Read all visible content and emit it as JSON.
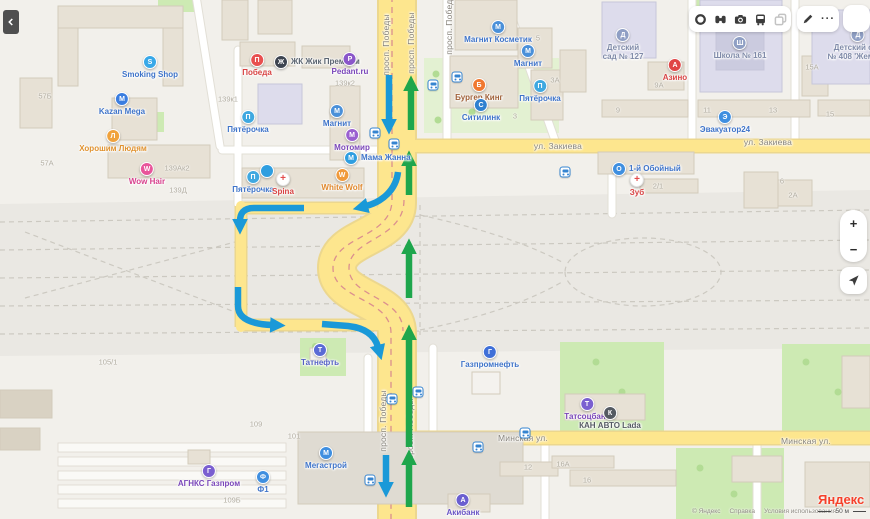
{
  "toolbar": {
    "more_label": "···"
  },
  "controls": {
    "zoom_in": "+",
    "zoom_out": "−"
  },
  "attribution": {
    "logo": "Яндекс",
    "copyright": "© Яндекс",
    "help": "Справка",
    "terms": "Условия использования",
    "scale": "50 м"
  },
  "map": {
    "streets": [
      {
        "text": "просп. Победы",
        "x": 386,
        "y": 45,
        "vertical": true
      },
      {
        "text": "просп. Победы",
        "x": 411,
        "y": 43,
        "vertical": true
      },
      {
        "text": "просп. Победы",
        "x": 449,
        "y": 24,
        "vertical": true
      },
      {
        "text": "просп. Победы",
        "x": 383,
        "y": 421,
        "vertical": true
      },
      {
        "text": "просп. Победы",
        "x": 410,
        "y": 429,
        "vertical": true
      },
      {
        "text": "ул. Закиева",
        "x": 558,
        "y": 146
      },
      {
        "text": "ул. Закиева",
        "x": 768,
        "y": 142
      },
      {
        "text": "Минская ул.",
        "x": 523,
        "y": 438
      },
      {
        "text": "Минская ул.",
        "x": 806,
        "y": 441
      }
    ],
    "pois": [
      {
        "label": "Smoking Shop",
        "x": 150,
        "y": 63,
        "color": "#38a8e8",
        "glyph": "S"
      },
      {
        "label": "Kazan Mega",
        "x": 122,
        "y": 100,
        "color": "#3a7de0",
        "glyph": "M"
      },
      {
        "label": "Хорошим Людям",
        "x": 113,
        "y": 137,
        "color": "#f0a23c",
        "glyph": "Л",
        "labelColor": "#e0922f"
      },
      {
        "label": "Wow Hair",
        "x": 147,
        "y": 170,
        "color": "#e8559a",
        "glyph": "W",
        "labelColor": "#d8418d"
      },
      {
        "label": "Победа",
        "x": 257,
        "y": 61,
        "color": "#e84f4f",
        "glyph": "П",
        "labelColor": "#d84343"
      },
      {
        "label": "ЖК Жик Премиум",
        "x": 282,
        "y": 62,
        "color": "#3d4450",
        "glyph": "Ж",
        "side": "right",
        "labelColor": "#5a6470"
      },
      {
        "label": "Pedant.ru",
        "x": 350,
        "y": 60,
        "color": "#8a56c9",
        "glyph": "P",
        "labelColor": "#7a46b9"
      },
      {
        "label": "Пятёрочка",
        "x": 248,
        "y": 118,
        "color": "#3fa8e0",
        "glyph": "П"
      },
      {
        "label": "Магнит",
        "x": 337,
        "y": 112,
        "color": "#4a90d9",
        "glyph": "М"
      },
      {
        "label": "Мотомир",
        "x": 352,
        "y": 136,
        "color": "#9a5fd0",
        "glyph": "М",
        "labelColor": "#7a46b9"
      },
      {
        "label": "Мама Жанна",
        "x": 352,
        "y": 158,
        "color": "#2f9ee0",
        "glyph": "М",
        "side": "right"
      },
      {
        "label": "Пятёрочка",
        "x": 253,
        "y": 178,
        "color": "#3fa8e0",
        "glyph": "П"
      },
      {
        "label": "Spina",
        "x": 283,
        "y": 180,
        "color": "#ffffff",
        "glyph": "+",
        "style": "cross",
        "labelColor": "#d84343"
      },
      {
        "label": "White Wolf",
        "x": 342,
        "y": 176,
        "color": "#f09a3c",
        "glyph": "W",
        "labelColor": "#e0892f"
      },
      {
        "label": "",
        "x": 267,
        "y": 172,
        "color": "#2f9ee0",
        "glyph": ""
      },
      {
        "label": "Магнит Косметик",
        "x": 498,
        "y": 28,
        "color": "#4a90d9",
        "glyph": "М"
      },
      {
        "label": "Магнит",
        "x": 528,
        "y": 52,
        "color": "#4a90d9",
        "glyph": "М"
      },
      {
        "label": "Бургер Кинг",
        "x": 479,
        "y": 86,
        "color": "#f07830",
        "glyph": "Б",
        "labelColor": "#a06038"
      },
      {
        "label": "Ситилинк",
        "x": 481,
        "y": 106,
        "color": "#2f80d0",
        "glyph": "С"
      },
      {
        "label": "Пятёрочка",
        "x": 540,
        "y": 87,
        "color": "#3fa8e0",
        "glyph": "П"
      },
      {
        "label": "Детский\nсад № 127",
        "x": 623,
        "y": 36,
        "color": "#8f9fc4",
        "glyph": "Д",
        "labelColor": "#7f8aa8"
      },
      {
        "label": "Школа № 161",
        "x": 740,
        "y": 44,
        "color": "#8f9fc4",
        "glyph": "Ш",
        "labelColor": "#7f8aa8"
      },
      {
        "label": "Азино",
        "x": 675,
        "y": 66,
        "color": "#e04545",
        "glyph": "А",
        "labelColor": "#d84343"
      },
      {
        "label": "Детский сад\n№ 408 'Жемчуж",
        "x": 858,
        "y": 36,
        "color": "#8f9fc4",
        "glyph": "Д",
        "labelColor": "#7f8aa8"
      },
      {
        "label": "Эвакуатор24",
        "x": 725,
        "y": 118,
        "color": "#3f8fe0",
        "glyph": "Э"
      },
      {
        "label": "1-й Обойный",
        "x": 620,
        "y": 169,
        "color": "#3f8fe0",
        "glyph": "О",
        "side": "right"
      },
      {
        "label": "Зуб",
        "x": 637,
        "y": 181,
        "color": "#ffffff",
        "glyph": "+",
        "style": "cross",
        "labelColor": "#d84343"
      },
      {
        "label": "Татнефть",
        "x": 320,
        "y": 351,
        "color": "#5b6bd5",
        "glyph": "Т",
        "labelColor": "#5560c5"
      },
      {
        "label": "Газпромнефть",
        "x": 490,
        "y": 353,
        "color": "#3f6fd8",
        "glyph": "Г"
      },
      {
        "label": "Татсоцбанк",
        "x": 587,
        "y": 405,
        "color": "#7a5fd0",
        "glyph": "Т",
        "labelColor": "#7a46b9"
      },
      {
        "label": "КАН АВТО Lada",
        "x": 610,
        "y": 414,
        "color": "#545a62",
        "glyph": "К",
        "labelColor": "#555b63"
      },
      {
        "label": "Мегастрой",
        "x": 326,
        "y": 454,
        "color": "#3f8fe0",
        "glyph": "М"
      },
      {
        "label": "АГНКС Газпром",
        "x": 209,
        "y": 472,
        "color": "#7a5fd0",
        "glyph": "Г",
        "labelColor": "#7a46b9"
      },
      {
        "label": "Ф1",
        "x": 263,
        "y": 478,
        "color": "#3f8fe0",
        "glyph": "Ф"
      },
      {
        "label": "Акибанк",
        "x": 463,
        "y": 501,
        "color": "#6a5fd0",
        "glyph": "А",
        "labelColor": "#6a55c5"
      }
    ],
    "bus_stops": [
      {
        "x": 375,
        "y": 133
      },
      {
        "x": 394,
        "y": 144
      },
      {
        "x": 433,
        "y": 85
      },
      {
        "x": 457,
        "y": 77
      },
      {
        "x": 392,
        "y": 399
      },
      {
        "x": 418,
        "y": 392
      },
      {
        "x": 370,
        "y": 480
      },
      {
        "x": 478,
        "y": 447
      },
      {
        "x": 525,
        "y": 433
      },
      {
        "x": 565,
        "y": 172
      }
    ],
    "building_numbers": [
      {
        "text": "57Б",
        "x": 45,
        "y": 96
      },
      {
        "text": "57А",
        "x": 47,
        "y": 163
      },
      {
        "text": "139Ак2",
        "x": 177,
        "y": 168
      },
      {
        "text": "139Д",
        "x": 178,
        "y": 190
      },
      {
        "text": "139к1",
        "x": 228,
        "y": 99
      },
      {
        "text": "139к2",
        "x": 345,
        "y": 83
      },
      {
        "text": "105/1",
        "x": 108,
        "y": 362
      },
      {
        "text": "109",
        "x": 256,
        "y": 424
      },
      {
        "text": "109Б",
        "x": 232,
        "y": 500
      },
      {
        "text": "101",
        "x": 294,
        "y": 436
      },
      {
        "text": "9А",
        "x": 659,
        "y": 85
      },
      {
        "text": "9",
        "x": 618,
        "y": 110
      },
      {
        "text": "11",
        "x": 707,
        "y": 110
      },
      {
        "text": "13",
        "x": 773,
        "y": 110
      },
      {
        "text": "15А",
        "x": 812,
        "y": 67
      },
      {
        "text": "15",
        "x": 830,
        "y": 114
      },
      {
        "text": "3А",
        "x": 555,
        "y": 80
      },
      {
        "text": "5",
        "x": 538,
        "y": 38
      },
      {
        "text": "3",
        "x": 515,
        "y": 116
      },
      {
        "text": "2/1",
        "x": 658,
        "y": 186
      },
      {
        "text": "2А",
        "x": 793,
        "y": 195
      },
      {
        "text": "6",
        "x": 782,
        "y": 181
      },
      {
        "text": "12",
        "x": 528,
        "y": 467
      },
      {
        "text": "16А",
        "x": 563,
        "y": 464
      },
      {
        "text": "16",
        "x": 587,
        "y": 480
      }
    ]
  },
  "route_arrows": {
    "colors": {
      "blue": "#1a99d8",
      "green": "#1ea64c"
    },
    "stroke_width": 6.5,
    "segments": [
      {
        "color": "blue",
        "path": "M389,75 L389,121"
      },
      {
        "color": "blue",
        "path": "M398,172 C396,190 382,202 366,206"
      },
      {
        "color": "blue",
        "path": "M304,208 L254,208 C243,208 240,214 240,221"
      },
      {
        "color": "blue",
        "path": "M238,287 L238,306 C238,318 250,324 272,325"
      },
      {
        "color": "blue",
        "path": "M322,324 L348,326 C366,328 375,336 378,347"
      },
      {
        "color": "blue",
        "path": "M386,455 L386,484"
      },
      {
        "color": "green",
        "path": "M411,130 L411,89"
      },
      {
        "color": "green",
        "path": "M409,195 L409,164"
      },
      {
        "color": "green",
        "path": "M409,298 L409,252"
      },
      {
        "color": "green",
        "path": "M409,447 L409,338"
      },
      {
        "color": "green",
        "path": "M409,507 L409,463"
      }
    ]
  }
}
